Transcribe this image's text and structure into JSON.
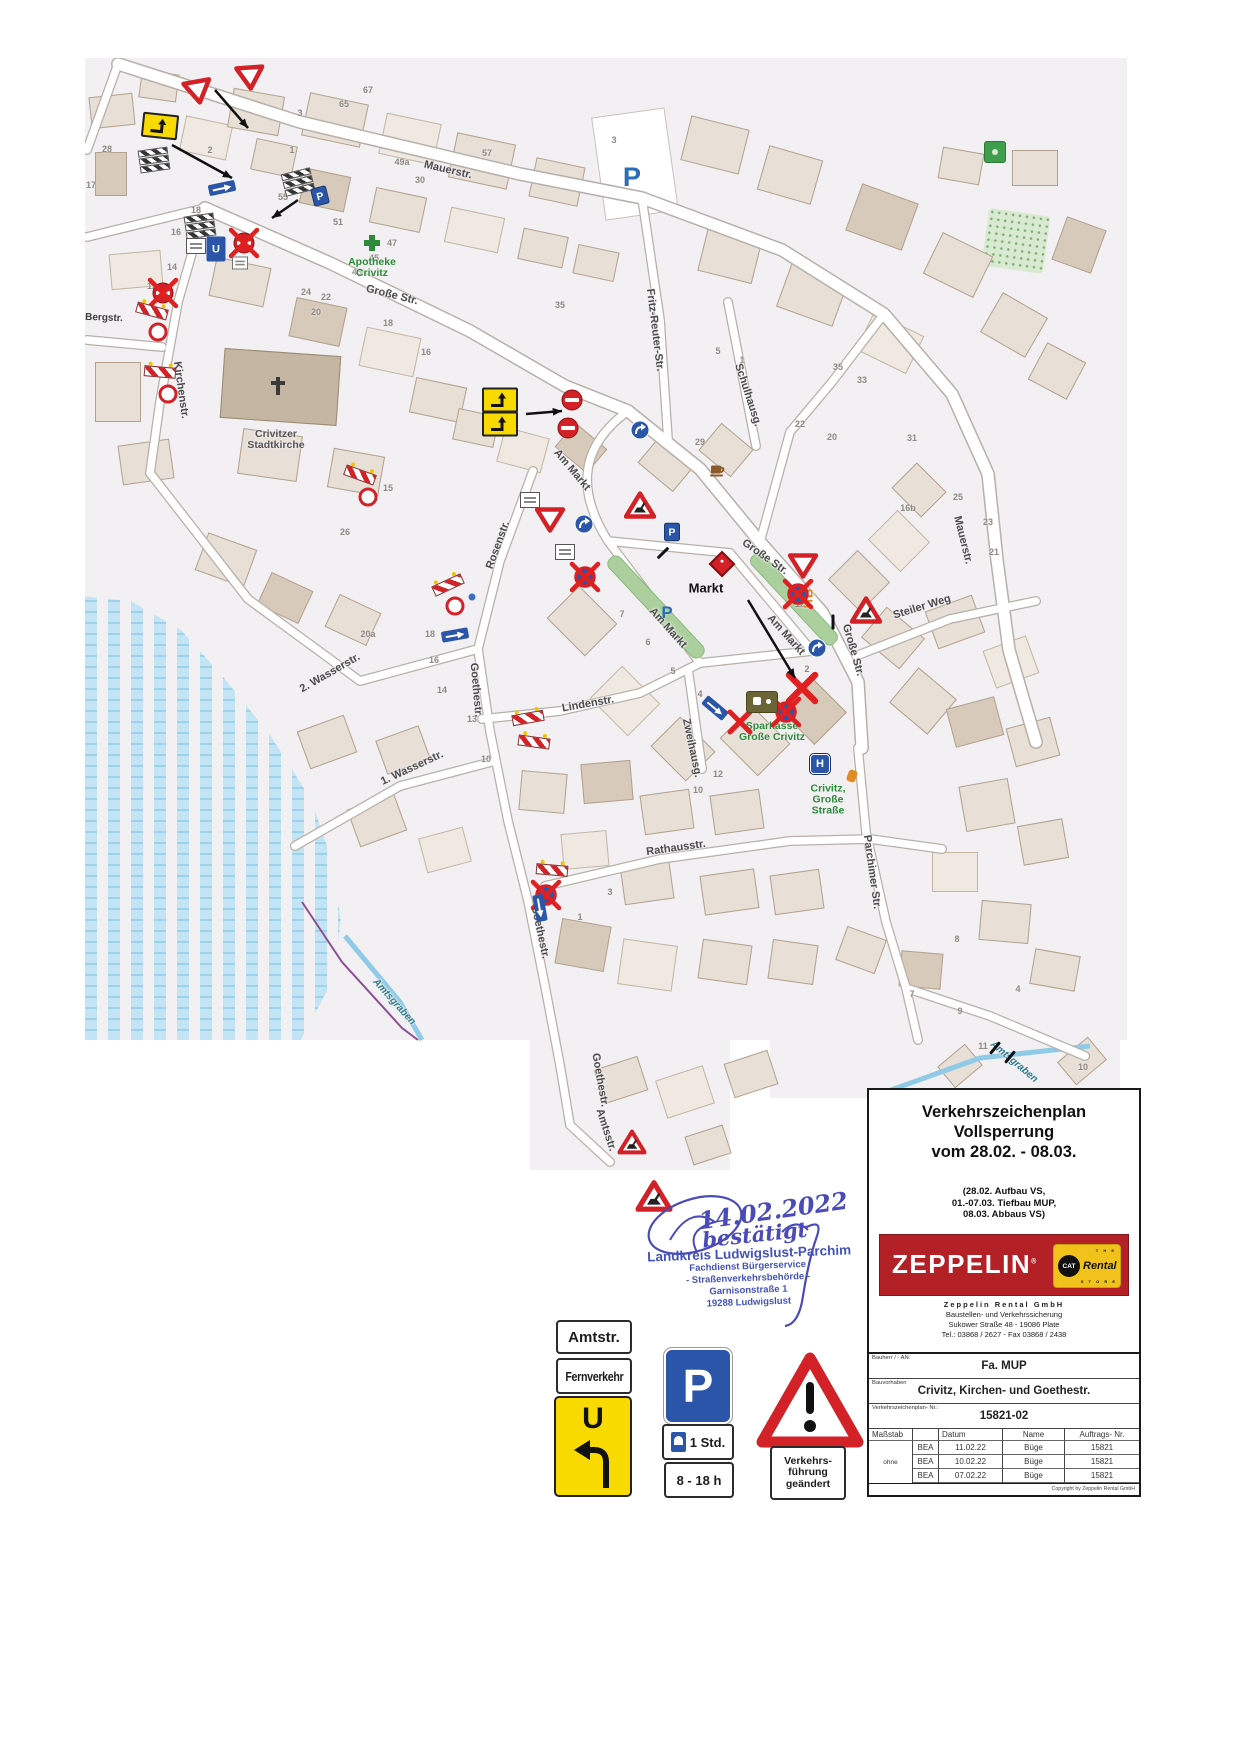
{
  "colors": {
    "zeppelin_red": "#b32025",
    "cat_yellow": "#f2c21c",
    "stamp_blue": "#4353b8",
    "sign_red": "#d22228",
    "parking_blue": "#2a55a8",
    "map_green": "#2e8b3a",
    "water_blue": "#c2e4f4"
  },
  "map": {
    "street_labels": [
      {
        "t": "Mauerstr.",
        "x": 448,
        "y": 170,
        "r": 13
      },
      {
        "t": "Große Str.",
        "x": 392,
        "y": 295,
        "r": 14
      },
      {
        "t": "Große Str.",
        "x": 765,
        "y": 557,
        "r": 35
      },
      {
        "t": "Große Str.",
        "x": 853,
        "y": 650,
        "r": 74
      },
      {
        "t": "Mauerstr.",
        "x": 963,
        "y": 540,
        "r": 76
      },
      {
        "t": "Fritz-Reuter-Str.",
        "x": 655,
        "y": 330,
        "r": 83
      },
      {
        "t": "Schulhausg.",
        "x": 748,
        "y": 395,
        "r": 72
      },
      {
        "t": "Bergstr.",
        "x": 104,
        "y": 318,
        "r": 2,
        "c": "sm"
      },
      {
        "t": "Kirchenstr.",
        "x": 181,
        "y": 390,
        "r": 82
      },
      {
        "t": "Rosenstr.",
        "x": 498,
        "y": 545,
        "r": -70
      },
      {
        "t": "Am Markt",
        "x": 572,
        "y": 470,
        "r": 50
      },
      {
        "t": "Am Markt",
        "x": 668,
        "y": 628,
        "r": 48
      },
      {
        "t": "Am Markt",
        "x": 786,
        "y": 635,
        "r": 48
      },
      {
        "t": "2. Wasserstr.",
        "x": 330,
        "y": 673,
        "r": -30
      },
      {
        "t": "1. Wasserstr.",
        "x": 412,
        "y": 768,
        "r": -25
      },
      {
        "t": "Goethestr.",
        "x": 476,
        "y": 690,
        "r": 85
      },
      {
        "t": "Goethestr.",
        "x": 540,
        "y": 932,
        "r": 78
      },
      {
        "t": "Goethestr.",
        "x": 600,
        "y": 1080,
        "r": 80,
        "c": "green"
      },
      {
        "t": "Lindenstr.",
        "x": 588,
        "y": 704,
        "r": -10
      },
      {
        "t": "Zweihausg.",
        "x": 692,
        "y": 748,
        "r": 78
      },
      {
        "t": "Rathausstr.",
        "x": 676,
        "y": 848,
        "r": -8
      },
      {
        "t": "Parchimer Str.",
        "x": 872,
        "y": 872,
        "r": 82
      },
      {
        "t": "Steiler Weg",
        "x": 922,
        "y": 607,
        "r": -17
      },
      {
        "t": "Amtsstr.",
        "x": 606,
        "y": 1130,
        "r": 72
      },
      {
        "t": "Amtsgraben",
        "x": 394,
        "y": 1002,
        "r": 48,
        "c": "teal"
      },
      {
        "t": "Amtsgraben",
        "x": 1014,
        "y": 1062,
        "r": 40,
        "c": "teal"
      }
    ],
    "poi_labels": [
      {
        "lines": [
          "Apotheke",
          "Crivitz"
        ],
        "x": 372,
        "y": 268,
        "c": "green"
      },
      {
        "lines": [
          "Crivitzer",
          "Stadtkirche"
        ],
        "x": 276,
        "y": 440,
        "c": "dark"
      },
      {
        "lines": [
          "Markt"
        ],
        "x": 706,
        "y": 588,
        "c": "big"
      },
      {
        "lines": [
          "Sparkasse",
          "Große Crivitz"
        ],
        "x": 772,
        "y": 732,
        "c": "green"
      },
      {
        "lines": [
          "Crivitz,",
          "Große",
          "Straße"
        ],
        "x": 828,
        "y": 800,
        "c": "green"
      },
      {
        "lines": [
          "HB"
        ],
        "x": 808,
        "y": 598,
        "c": "hb",
        "r": -90
      }
    ],
    "house_numbers": [
      [
        "28",
        107,
        149
      ],
      [
        "2",
        210,
        150
      ],
      [
        "1",
        292,
        150
      ],
      [
        "3",
        300,
        113
      ],
      [
        "67",
        368,
        90
      ],
      [
        "65",
        344,
        104
      ],
      [
        "57",
        487,
        153
      ],
      [
        "55",
        283,
        197
      ],
      [
        "51",
        338,
        222
      ],
      [
        "49a",
        402,
        162
      ],
      [
        "30",
        420,
        180
      ],
      [
        "47",
        392,
        243
      ],
      [
        "45",
        374,
        258
      ],
      [
        "43",
        357,
        272
      ],
      [
        "18",
        196,
        210
      ],
      [
        "16",
        176,
        232
      ],
      [
        "14",
        172,
        267
      ],
      [
        "12",
        152,
        286
      ],
      [
        "17",
        91,
        185
      ],
      [
        "24",
        306,
        292
      ],
      [
        "22",
        326,
        297
      ],
      [
        "20",
        316,
        312
      ],
      [
        "16",
        426,
        352
      ],
      [
        "35",
        560,
        305
      ],
      [
        "18",
        388,
        323
      ],
      [
        "29",
        700,
        442
      ],
      [
        "22",
        800,
        424
      ],
      [
        "20",
        832,
        437
      ],
      [
        "31",
        912,
        438
      ],
      [
        "35",
        838,
        367
      ],
      [
        "33",
        862,
        380
      ],
      [
        "16b",
        908,
        508
      ],
      [
        "25",
        958,
        497
      ],
      [
        "23",
        988,
        522
      ],
      [
        "21",
        994,
        552
      ],
      [
        "15",
        388,
        488
      ],
      [
        "26",
        345,
        532
      ],
      [
        "20a",
        368,
        634
      ],
      [
        "18",
        430,
        634
      ],
      [
        "16",
        434,
        660
      ],
      [
        "14",
        442,
        690
      ],
      [
        "13",
        472,
        719
      ],
      [
        "10",
        486,
        759
      ],
      [
        "7",
        622,
        614
      ],
      [
        "6",
        648,
        642
      ],
      [
        "5",
        673,
        671
      ],
      [
        "4",
        700,
        694
      ],
      [
        "2",
        807,
        669
      ],
      [
        "12",
        800,
        604
      ],
      [
        "1",
        580,
        917
      ],
      [
        "3",
        610,
        892
      ],
      [
        "12",
        718,
        774
      ],
      [
        "10",
        698,
        790
      ],
      [
        "9",
        960,
        1011
      ],
      [
        "7",
        912,
        994
      ],
      [
        "11",
        983,
        1046
      ],
      [
        "4",
        1018,
        989
      ],
      [
        "10",
        1083,
        1067
      ],
      [
        "8",
        957,
        939
      ],
      [
        "5",
        718,
        351
      ],
      [
        "1",
        742,
        360
      ],
      [
        "3",
        614,
        140
      ]
    ],
    "signs": [
      {
        "t": "yield",
        "x": 198,
        "y": 92,
        "r": -10
      },
      {
        "t": "yield",
        "x": 250,
        "y": 78,
        "r": -4
      },
      {
        "t": "detour",
        "x": 160,
        "y": 126,
        "r": 6
      },
      {
        "t": "boards",
        "x": 154,
        "y": 160,
        "r": -8
      },
      {
        "t": "boards",
        "x": 298,
        "y": 182,
        "r": -14
      },
      {
        "t": "pblue",
        "x": 320,
        "y": 196,
        "r": -14,
        "s": 0.8
      },
      {
        "t": "oneway",
        "x": 222,
        "y": 188,
        "r": -12
      },
      {
        "t": "noentry",
        "x": 244,
        "y": 243,
        "k": 1
      },
      {
        "t": "boards",
        "x": 200,
        "y": 226,
        "r": -8
      },
      {
        "t": "plate",
        "x": 196,
        "y": 246
      },
      {
        "t": "ublue",
        "x": 216,
        "y": 249
      },
      {
        "t": "plate",
        "x": 240,
        "y": 263,
        "s": 0.8
      },
      {
        "t": "noentry",
        "x": 163,
        "y": 293,
        "k": 1
      },
      {
        "t": "barrier",
        "x": 152,
        "y": 311,
        "r": 15
      },
      {
        "t": "circlerw",
        "x": 158,
        "y": 332
      },
      {
        "t": "barrier",
        "x": 160,
        "y": 372,
        "r": 5
      },
      {
        "t": "circlerw",
        "x": 168,
        "y": 394
      },
      {
        "t": "barrier",
        "x": 360,
        "y": 475,
        "r": 20
      },
      {
        "t": "circlerw",
        "x": 368,
        "y": 497
      },
      {
        "t": "detour",
        "x": 500,
        "y": 400
      },
      {
        "t": "detour",
        "x": 500,
        "y": 424
      },
      {
        "t": "noentry",
        "x": 572,
        "y": 400
      },
      {
        "t": "noentry",
        "x": 568,
        "y": 428
      },
      {
        "t": "plate",
        "x": 530,
        "y": 500
      },
      {
        "t": "yield",
        "x": 550,
        "y": 520
      },
      {
        "t": "bluecircle",
        "x": 584,
        "y": 524
      },
      {
        "t": "plate",
        "x": 565,
        "y": 552
      },
      {
        "t": "nostop",
        "x": 585,
        "y": 577,
        "k": 1
      },
      {
        "t": "bluecircle",
        "x": 640,
        "y": 430
      },
      {
        "t": "warnrw",
        "x": 640,
        "y": 505
      },
      {
        "t": "pblue",
        "x": 672,
        "y": 532,
        "s": 0.8
      },
      {
        "t": "pletter",
        "x": 632,
        "y": 178,
        "s": 1.6
      },
      {
        "t": "pletter",
        "x": 667,
        "y": 613
      },
      {
        "t": "pin",
        "x": 722,
        "y": 564
      },
      {
        "t": "cafe",
        "x": 718,
        "y": 470
      },
      {
        "t": "yield",
        "x": 803,
        "y": 566
      },
      {
        "t": "nostop",
        "x": 798,
        "y": 594,
        "k": 1
      },
      {
        "t": "bluecircle",
        "x": 817,
        "y": 648
      },
      {
        "t": "redx",
        "x": 802,
        "y": 688,
        "s": 1.3
      },
      {
        "t": "nostop",
        "x": 786,
        "y": 712,
        "k": 1
      },
      {
        "t": "warnrw",
        "x": 866,
        "y": 610
      },
      {
        "t": "redx",
        "x": 740,
        "y": 722
      },
      {
        "t": "spk",
        "x": 762,
        "y": 702
      },
      {
        "t": "barrier",
        "x": 448,
        "y": 585,
        "r": -25
      },
      {
        "t": "circlerw",
        "x": 455,
        "y": 606
      },
      {
        "t": "dotblue",
        "x": 472,
        "y": 597
      },
      {
        "t": "oneway",
        "x": 455,
        "y": 635,
        "r": -10
      },
      {
        "t": "oneway",
        "x": 715,
        "y": 708,
        "r": 40
      },
      {
        "t": "barrier",
        "x": 528,
        "y": 718,
        "r": -10
      },
      {
        "t": "barrier",
        "x": 534,
        "y": 742,
        "r": 8
      },
      {
        "t": "barrier",
        "x": 552,
        "y": 870,
        "r": 5
      },
      {
        "t": "nostop",
        "x": 546,
        "y": 895,
        "k": 1
      },
      {
        "t": "oneway",
        "x": 540,
        "y": 908,
        "r": 80
      },
      {
        "t": "warnrw",
        "x": 632,
        "y": 1142,
        "s": 0.9
      },
      {
        "t": "warnrw",
        "x": 654,
        "y": 1196,
        "s": 1.15
      },
      {
        "t": "bus",
        "x": 820,
        "y": 764
      },
      {
        "t": "dotorange",
        "x": 852,
        "y": 776
      },
      {
        "t": "greensq",
        "x": 995,
        "y": 152
      },
      {
        "t": "gcross",
        "x": 372,
        "y": 243
      },
      {
        "t": "cross",
        "x": 278,
        "y": 386
      },
      {
        "t": "tick",
        "x": 995,
        "y": 1048,
        "r": 40
      },
      {
        "t": "tick",
        "x": 1010,
        "y": 1057,
        "r": 40
      },
      {
        "t": "tick",
        "x": 833,
        "y": 622,
        "r": 0
      },
      {
        "t": "tick",
        "x": 663,
        "y": 553,
        "r": 45
      }
    ],
    "annotation_arrows": [
      [
        215,
        90,
        248,
        128
      ],
      [
        172,
        145,
        232,
        178
      ],
      [
        298,
        200,
        272,
        218
      ],
      [
        526,
        414,
        562,
        411
      ],
      [
        748,
        600,
        795,
        678
      ]
    ]
  },
  "stamp": {
    "handwriting": {
      "date": "14.02.2022",
      "word": "bestätigt"
    },
    "lines": [
      "Landkreis Ludwigslust-Parchim",
      "Fachdienst Bürgerservice",
      "- Straßenverkehrsbehörde -",
      "Garnisonstraße 1",
      "19288 Ludwigslust"
    ]
  },
  "legend": {
    "amtstr_label": "Amtstr.",
    "fernverkehr_label": "Fernverkehr",
    "u_letter": "U",
    "parking": {
      "p": "P",
      "duration": "1 Std.",
      "hours": "8 - 18 h"
    },
    "warning": {
      "lines": [
        "Verkehrs-",
        "führung",
        "geändert"
      ]
    }
  },
  "info_box": {
    "title_lines": [
      "Verkehrszeichenplan",
      "Vollsperrung",
      "vom 28.02. - 08.03."
    ],
    "subtitle_lines": [
      "(28.02. Aufbau VS,",
      "01.-07.03. Tiefbau MUP,",
      "08.03. Abbaus VS)"
    ],
    "brand": {
      "name": "ZEPPELIN",
      "reg": "®",
      "cat": "CAT",
      "rental": "Rental",
      "store_top": "T H E",
      "store_bottom": "S T O R E"
    },
    "company_lines": [
      "Zeppelin Rental GmbH",
      "Baustellen- und Verkehrssicherung",
      "Sukower Straße 48  -  19086 Plate",
      "Tel.: 03868 / 2627  -  Fax 03868 / 2438"
    ],
    "fields": [
      {
        "label": "Bauherr / - AN:",
        "value": "Fa. MUP"
      },
      {
        "label": "Bauvorhaben",
        "value": "Crivitz, Kirchen- und Goethestr."
      },
      {
        "label": "Verkehrszeichenplan- Nr.:",
        "value": "15821-02"
      }
    ],
    "table": {
      "headers": [
        "Maßstab",
        "",
        "Datum",
        "Name",
        "Auftrags- Nr."
      ],
      "scale_value": "ohne",
      "rows": [
        [
          "BEA",
          "11.02.22",
          "Büge",
          "15821"
        ],
        [
          "BEA",
          "10.02.22",
          "Büge",
          "15821"
        ],
        [
          "BEA",
          "07.02.22",
          "Büge",
          "15821"
        ]
      ]
    },
    "copyright": "Copyright by Zeppelin Rental GmbH"
  }
}
